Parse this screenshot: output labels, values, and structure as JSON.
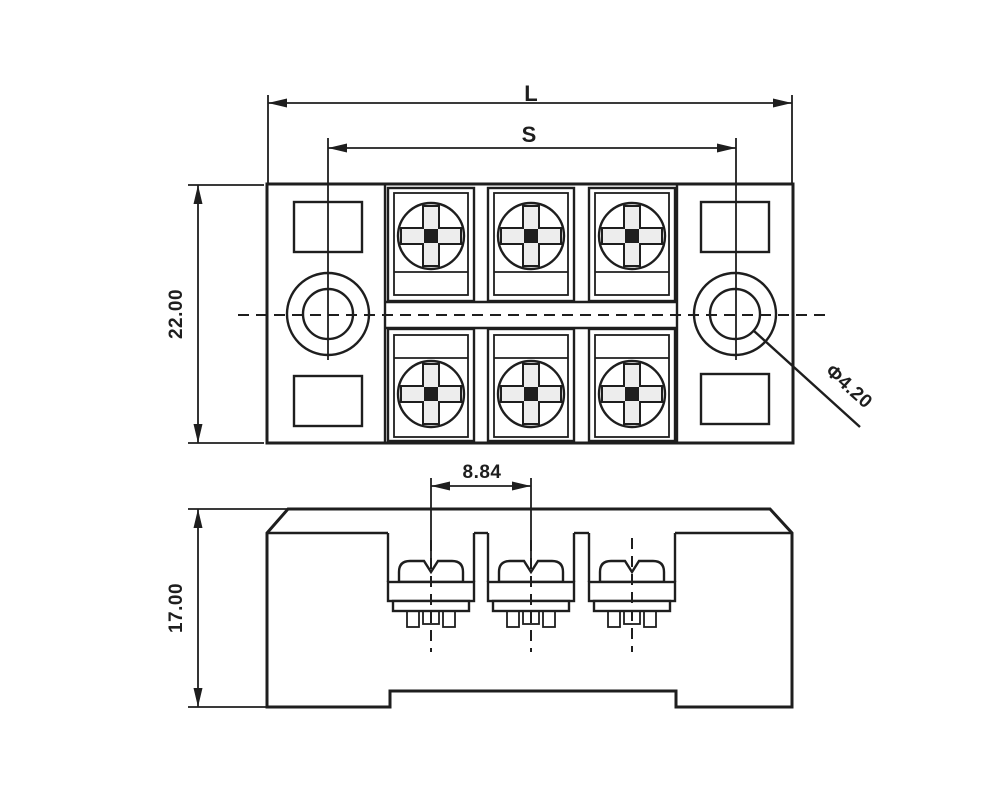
{
  "drawing": {
    "title_note": "terminal block dimension drawing",
    "dims": {
      "overall_length_label": "L",
      "mount_hole_spacing_label": "S",
      "body_width": "22.00",
      "terminal_pitch": "8.84",
      "front_height": "17.00",
      "mount_hole_diameter": "Φ4.20"
    },
    "colors": {
      "ink": "#1e1e1e",
      "paper": "#ffffff"
    }
  }
}
